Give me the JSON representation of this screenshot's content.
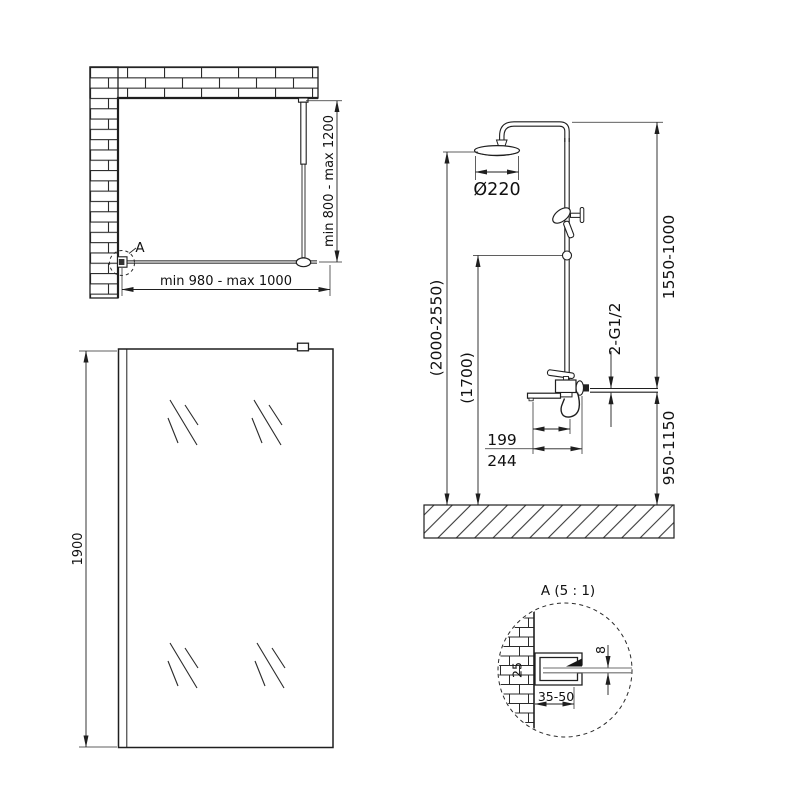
{
  "drawing": {
    "background": "#ffffff",
    "line_color": "#1f1f1f",
    "glass_color": "#9a9a9a",
    "views": {
      "plan": {
        "width_dim": "min 980 - max 1000",
        "depth_dim": "min 800 - max 1200",
        "detail_marker": "A"
      },
      "front": {
        "height_dim": "1900"
      },
      "shower": {
        "head_diameter": "Ø220",
        "overall_height": "(2000-2550)",
        "hand_shower_height": "(1700)",
        "riser_height": "1550-1000",
        "mixer_height": "950-1150",
        "connection": "2-G1/2",
        "spout_reach": "199",
        "spout_total": "244"
      },
      "detail": {
        "title": "A (5 : 1)",
        "profile_height": "25",
        "glass_thickness": "8",
        "mount_depth": "35-50"
      }
    }
  }
}
